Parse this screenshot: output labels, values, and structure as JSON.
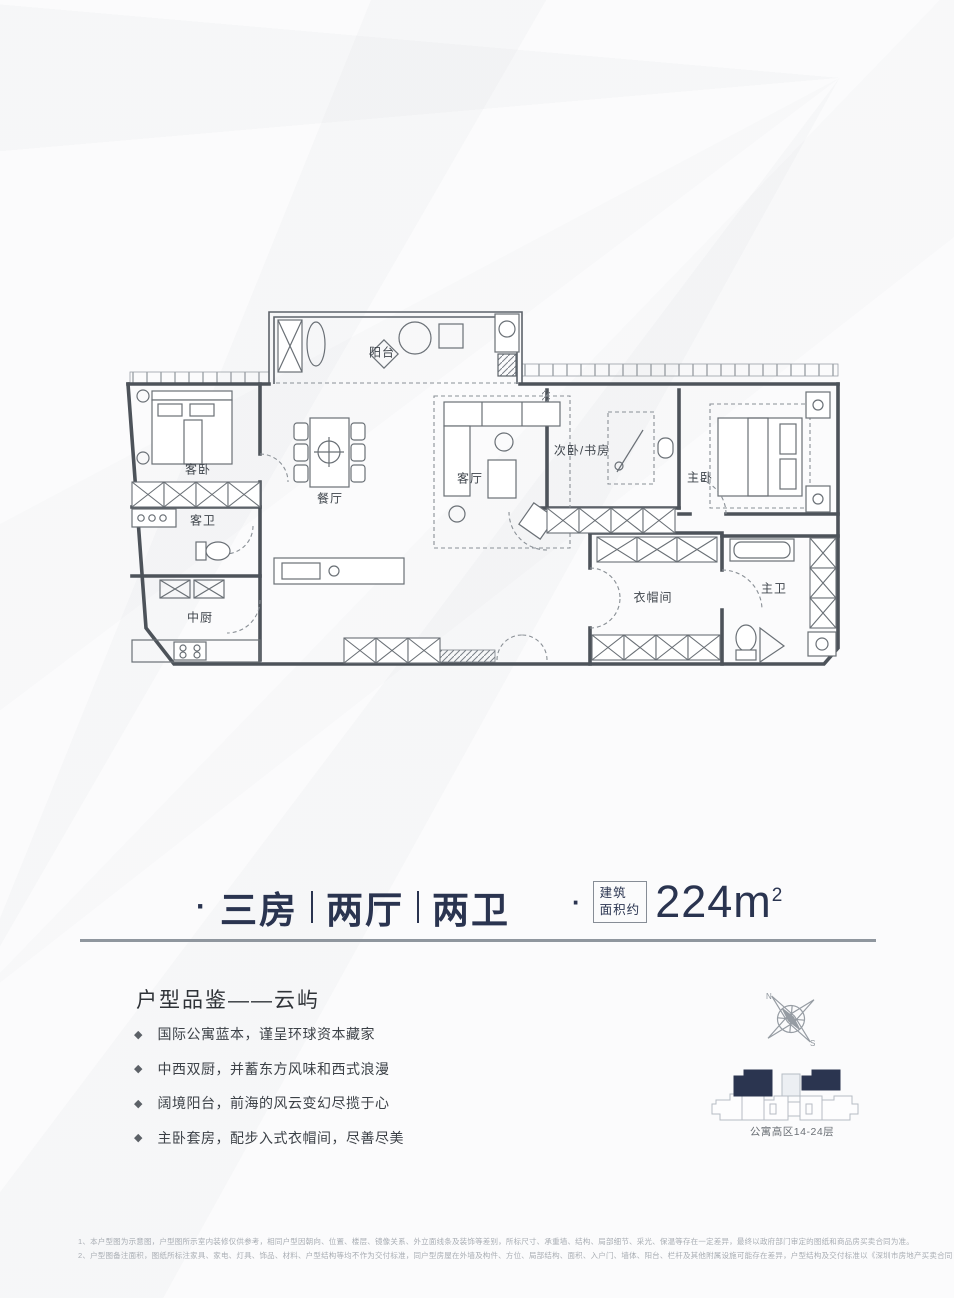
{
  "floor_plan": {
    "rooms": [
      {
        "name": "balcony",
        "label": "阳台"
      },
      {
        "name": "guest-bedroom",
        "label": "客卧"
      },
      {
        "name": "guest-bathroom",
        "label": "客卫"
      },
      {
        "name": "dining-room",
        "label": "餐厅"
      },
      {
        "name": "living-room",
        "label": "客厅"
      },
      {
        "name": "second-bedroom-study",
        "label": "次卧/书房"
      },
      {
        "name": "master-bedroom",
        "label": "主卧"
      },
      {
        "name": "cloakroom",
        "label": "衣帽间"
      },
      {
        "name": "master-bathroom",
        "label": "主卫"
      },
      {
        "name": "chinese-kitchen",
        "label": "中厨"
      }
    ]
  },
  "title": {
    "bullet": "·",
    "parts": [
      "三房",
      "两厅",
      "两卫"
    ],
    "area_bullet": "·",
    "area_box_line1": "建筑",
    "area_box_line2": "面积约",
    "area_value": "224m",
    "area_superscript": "2"
  },
  "section": {
    "heading": "户型品鉴——云屿",
    "bullet_marker": "◆",
    "bullets": [
      "国际公寓蓝本，谨呈环球资本藏家",
      "中西双厨，并蓄东方风味和西式浪漫",
      "阔境阳台，前海的风云变幻尽揽于心",
      "主卧套房，配步入式衣帽间，尽善尽美"
    ]
  },
  "compass": {
    "north_label": "N",
    "south_label": "S"
  },
  "building": {
    "caption": "公寓高区14-24层",
    "highlight_color": "#2b3550"
  },
  "disclaimer": {
    "line1": "1、本户型图为示意图，户型图所示室内装修仅供参考，相同户型因朝向、位置、楼层、镜像关系、外立面线条及装饰等差别，所标尺寸、承重墙、结构、局部细节、采光、保温等存在一定差异，最终以政府部门审定的图纸和商品房买卖合同为准。",
    "line2": "2、户型图备注面积，图纸所标注家具、家电、灯具、饰品、材料、户型结构等均不作为交付标准，同户型房屋在外墙及构件、方位、局部结构、面积、入户门、墙体、阳台、栏杆及其他附属设施可能存在差异，户型结构及交付标准以《深圳市房地产买卖合同（预售）》之约定为准。"
  },
  "colors": {
    "navy": "#2a3450",
    "wall_gray": "#4d535a",
    "divider": "#8f969e",
    "disclaimer_text": "#a8adb3"
  }
}
